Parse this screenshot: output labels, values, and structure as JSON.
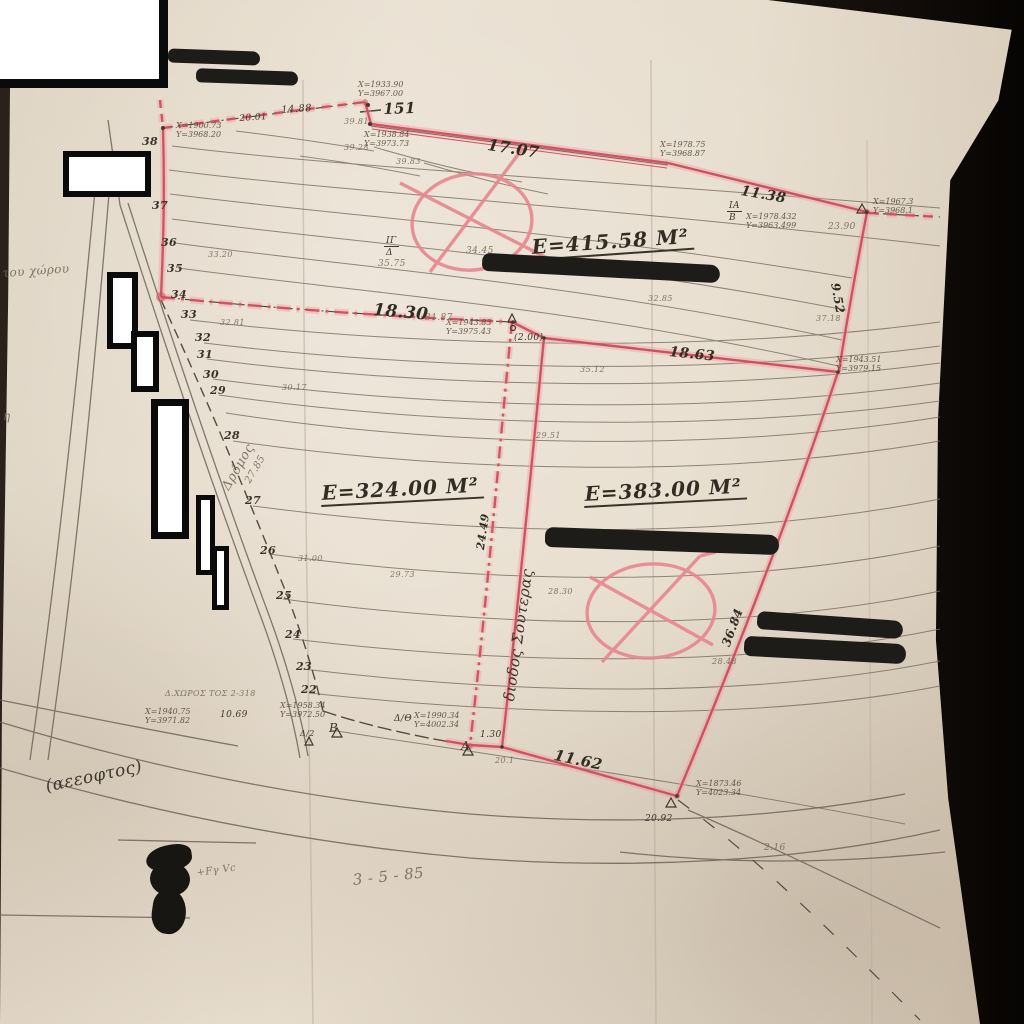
{
  "colors": {
    "boundary_red": "#cf4f5c",
    "paper": "#e6dccd",
    "ink": "#3f372c",
    "pencil_gray": "#77695A",
    "marker_black": "#1e1c19"
  },
  "annotations": [
    {
      "name": "parcel-area-1",
      "t": "E=415.58 M²",
      "x": 530,
      "y": 236,
      "s": 20,
      "r": -4,
      "cls": "area"
    },
    {
      "name": "parcel-area-2",
      "t": "E=324.00 M²",
      "x": 320,
      "y": 482,
      "s": 20,
      "r": -3,
      "cls": "area"
    },
    {
      "name": "parcel-area-3",
      "t": "E=383.00 M²",
      "x": 583,
      "y": 483,
      "s": 20,
      "r": -3,
      "cls": "area"
    },
    {
      "name": "length-151",
      "t": "151",
      "x": 383,
      "y": 101,
      "s": 15,
      "r": -2,
      "cls": "len"
    },
    {
      "name": "length-17-07",
      "t": "17.07",
      "x": 489,
      "y": 136,
      "s": 16,
      "r": 9,
      "cls": "len"
    },
    {
      "name": "length-11-38",
      "t": "11.38",
      "x": 742,
      "y": 184,
      "s": 14,
      "r": 10,
      "cls": "len"
    },
    {
      "name": "length-18-30",
      "t": "18.30",
      "x": 374,
      "y": 301,
      "s": 17,
      "r": 5,
      "cls": "len"
    },
    {
      "name": "length-18-63",
      "t": "18.63",
      "x": 670,
      "y": 345,
      "s": 14,
      "r": 6,
      "cls": "len"
    },
    {
      "name": "length-11-62",
      "t": "11.62",
      "x": 556,
      "y": 747,
      "s": 15,
      "r": 12,
      "cls": "len"
    },
    {
      "name": "length-9-52",
      "t": "9.52",
      "x": 841,
      "y": 282,
      "s": 12,
      "r": 80,
      "cls": "len"
    },
    {
      "name": "length-24-49",
      "t": "24.49",
      "x": 475,
      "y": 549,
      "s": 11,
      "r": -82,
      "cls": "len"
    },
    {
      "name": "length-36-84",
      "t": "36.84",
      "x": 720,
      "y": 644,
      "s": 12,
      "r": -70,
      "cls": "len"
    },
    {
      "name": "length-14-88",
      "t": "14.88",
      "x": 281,
      "y": 105,
      "s": 10,
      "r": -4,
      "cls": "ink"
    },
    {
      "name": "length-20-01",
      "t": "20.01",
      "x": 239,
      "y": 114,
      "s": 9,
      "r": -4,
      "cls": "ink"
    },
    {
      "name": "length-31-87",
      "t": "31.87",
      "x": 425,
      "y": 313,
      "s": 9,
      "cls": "pencil"
    },
    {
      "name": "length-10-69",
      "t": "10.69",
      "x": 220,
      "y": 710,
      "s": 9,
      "cls": "ink"
    },
    {
      "name": "length-1-30",
      "t": "1.30",
      "x": 480,
      "y": 730,
      "s": 9,
      "cls": "ink"
    },
    {
      "name": "length-2-00",
      "t": "(2.00)",
      "x": 514,
      "y": 333,
      "s": 9,
      "cls": "ink"
    },
    {
      "name": "length-2-16",
      "t": "2.16",
      "x": 764,
      "y": 843,
      "s": 9,
      "cls": "pencil"
    },
    {
      "name": "length-20-92",
      "t": "20.92",
      "x": 645,
      "y": 814,
      "s": 9,
      "cls": "ink"
    },
    {
      "name": "length-20-1",
      "t": "20.1",
      "x": 495,
      "y": 757,
      "s": 8,
      "cls": "pencil"
    },
    {
      "name": "corridor-label",
      "t": "διοδος Σουτερας",
      "x": 501,
      "y": 700,
      "s": 15,
      "r": -82,
      "cls": "ink"
    },
    {
      "name": "road-label",
      "t": "Δρόμος",
      "x": 220,
      "y": 486,
      "s": 13,
      "r": -60,
      "cls": "pencil"
    },
    {
      "name": "elev-27-85",
      "t": "27.85",
      "x": 243,
      "y": 480,
      "s": 10,
      "r": -60,
      "cls": "pencil"
    },
    {
      "name": "contour-38",
      "t": "38",
      "x": 142,
      "y": 136,
      "s": 11,
      "cls": "num"
    },
    {
      "name": "contour-37",
      "t": "37",
      "x": 152,
      "y": 200,
      "s": 11,
      "cls": "num"
    },
    {
      "name": "contour-36",
      "t": "36",
      "x": 161,
      "y": 237,
      "s": 11,
      "cls": "num"
    },
    {
      "name": "contour-35",
      "t": "35",
      "x": 167,
      "y": 263,
      "s": 11,
      "cls": "num"
    },
    {
      "name": "contour-34",
      "t": "34",
      "x": 171,
      "y": 289,
      "s": 11,
      "cls": "num"
    },
    {
      "name": "contour-33",
      "t": "33",
      "x": 181,
      "y": 309,
      "s": 11,
      "cls": "num"
    },
    {
      "name": "contour-32",
      "t": "32",
      "x": 195,
      "y": 332,
      "s": 11,
      "cls": "num"
    },
    {
      "name": "contour-31",
      "t": "31",
      "x": 197,
      "y": 349,
      "s": 11,
      "cls": "num"
    },
    {
      "name": "contour-30",
      "t": "30",
      "x": 203,
      "y": 369,
      "s": 11,
      "cls": "num"
    },
    {
      "name": "contour-29",
      "t": "29",
      "x": 210,
      "y": 385,
      "s": 11,
      "cls": "num"
    },
    {
      "name": "contour-28",
      "t": "28",
      "x": 224,
      "y": 430,
      "s": 11,
      "cls": "num"
    },
    {
      "name": "contour-27",
      "t": "27",
      "x": 245,
      "y": 495,
      "s": 11,
      "cls": "num"
    },
    {
      "name": "contour-26",
      "t": "26",
      "x": 260,
      "y": 545,
      "s": 11,
      "cls": "num"
    },
    {
      "name": "contour-25",
      "t": "25",
      "x": 276,
      "y": 590,
      "s": 11,
      "cls": "num"
    },
    {
      "name": "contour-24",
      "t": "24",
      "x": 285,
      "y": 629,
      "s": 11,
      "cls": "num"
    },
    {
      "name": "contour-23",
      "t": "23",
      "x": 296,
      "y": 661,
      "s": 11,
      "cls": "num"
    },
    {
      "name": "contour-22",
      "t": "22",
      "x": 301,
      "y": 684,
      "s": 11,
      "cls": "num"
    },
    {
      "name": "survey-coordinates",
      "t": "Χ=1900.73\nΥ=3968.20",
      "x": 176,
      "y": 122,
      "s": 8,
      "cls": "coords"
    },
    {
      "name": "survey-coordinates",
      "t": "Χ=1933.90\nΥ=3967.00",
      "x": 358,
      "y": 81,
      "s": 8,
      "cls": "coords"
    },
    {
      "name": "survey-coordinates",
      "t": "Χ=1938.84\nΥ=3973.73",
      "x": 364,
      "y": 131,
      "s": 8,
      "cls": "coords"
    },
    {
      "name": "survey-coordinates",
      "t": "Χ=1978.75\nΥ=3968.87",
      "x": 660,
      "y": 141,
      "s": 8,
      "cls": "coords"
    },
    {
      "name": "survey-coordinates",
      "t": "Χ=1967.3\nΥ=3968.1",
      "x": 873,
      "y": 198,
      "s": 8,
      "cls": "coords"
    },
    {
      "name": "survey-coordinates",
      "t": "Χ=1978.432\nΥ=3963.499",
      "x": 746,
      "y": 213,
      "s": 8,
      "cls": "coords"
    },
    {
      "name": "survey-coordinates",
      "t": "Χ=1943.83\nΥ=3975.43",
      "x": 446,
      "y": 319,
      "s": 8,
      "cls": "coords"
    },
    {
      "name": "survey-coordinates",
      "t": "Χ=1943.51\nΥ=3979.15",
      "x": 836,
      "y": 356,
      "s": 8,
      "cls": "coords"
    },
    {
      "name": "survey-coordinates",
      "t": "Χ=1940.75\nΥ=3971.82",
      "x": 145,
      "y": 708,
      "s": 8,
      "cls": "coords"
    },
    {
      "name": "survey-coordinates",
      "t": "Χ=1958.34\nΥ=3972.50",
      "x": 280,
      "y": 702,
      "s": 8,
      "cls": "coords"
    },
    {
      "name": "survey-coordinates",
      "t": "Χ=1990.34\nΥ=4002.34",
      "x": 414,
      "y": 712,
      "s": 8,
      "cls": "coords"
    },
    {
      "name": "survey-coordinates",
      "t": "Χ=1873.46\nΥ=4023.34",
      "x": 696,
      "y": 780,
      "s": 8,
      "cls": "coords"
    },
    {
      "name": "station-ia",
      "t": "ΙΑ",
      "x": 727,
      "y": 201,
      "s": 9,
      "cls": "frac"
    },
    {
      "name": "station-b-small",
      "t": "Β",
      "x": 729,
      "y": 213,
      "s": 9,
      "cls": "ink"
    },
    {
      "name": "station-ig",
      "t": "ΙΓ",
      "x": 384,
      "y": 236,
      "s": 9,
      "cls": "frac"
    },
    {
      "name": "station-d-small",
      "t": "Δ",
      "x": 386,
      "y": 248,
      "s": 9,
      "cls": "ink"
    },
    {
      "name": "elev-35-75",
      "t": "35.75",
      "x": 378,
      "y": 259,
      "s": 9,
      "cls": "pencil"
    },
    {
      "name": "elev-34-45",
      "t": "34.45",
      "x": 466,
      "y": 246,
      "s": 9,
      "cls": "pencil"
    },
    {
      "name": "station-gamma",
      "t": "Γ",
      "x": 607,
      "y": 261,
      "s": 10,
      "cls": "ink"
    },
    {
      "name": "station-B",
      "t": "Β",
      "x": 329,
      "y": 722,
      "s": 12,
      "cls": "ink"
    },
    {
      "name": "station-A",
      "t": "Α",
      "x": 461,
      "y": 740,
      "s": 12,
      "cls": "ink"
    },
    {
      "name": "station-d-theta",
      "t": "Δ/Θ",
      "x": 394,
      "y": 714,
      "s": 9,
      "cls": "ink"
    },
    {
      "name": "station-d-2",
      "t": "Δ/2",
      "x": 300,
      "y": 730,
      "s": 8,
      "cls": "ink"
    },
    {
      "name": "elev-39-81",
      "t": "39.81",
      "x": 344,
      "y": 118,
      "s": 8,
      "cls": "pencil"
    },
    {
      "name": "elev-39-28",
      "t": "39.28",
      "x": 344,
      "y": 144,
      "s": 8,
      "cls": "pencil"
    },
    {
      "name": "elev-39-83",
      "t": "39.83",
      "x": 396,
      "y": 158,
      "s": 8,
      "cls": "pencil"
    },
    {
      "name": "elev-23-90",
      "t": "23.90",
      "x": 828,
      "y": 222,
      "s": 9,
      "cls": "pencil"
    },
    {
      "name": "elev-33-20",
      "t": "33.20",
      "x": 208,
      "y": 251,
      "s": 8,
      "cls": "pencil"
    },
    {
      "name": "elev-32-81",
      "t": "32.81",
      "x": 220,
      "y": 319,
      "s": 8,
      "cls": "pencil"
    },
    {
      "name": "elev-32-85",
      "t": "32.85",
      "x": 648,
      "y": 295,
      "s": 8,
      "cls": "pencil"
    },
    {
      "name": "elev-37-18",
      "t": "37.18",
      "x": 816,
      "y": 315,
      "s": 8,
      "cls": "pencil"
    },
    {
      "name": "elev-35-12",
      "t": "35.12",
      "x": 580,
      "y": 366,
      "s": 8,
      "cls": "pencil"
    },
    {
      "name": "elev-30-17",
      "t": "30.17",
      "x": 282,
      "y": 384,
      "s": 8,
      "cls": "pencil"
    },
    {
      "name": "elev-29-51",
      "t": "29.51",
      "x": 536,
      "y": 432,
      "s": 8,
      "cls": "pencil"
    },
    {
      "name": "elev-31-00",
      "t": "31.00",
      "x": 298,
      "y": 555,
      "s": 8,
      "cls": "pencil"
    },
    {
      "name": "elev-29-73",
      "t": "29.73",
      "x": 390,
      "y": 571,
      "s": 8,
      "cls": "pencil"
    },
    {
      "name": "elev-28-30",
      "t": "28.30",
      "x": 548,
      "y": 588,
      "s": 8,
      "cls": "pencil"
    },
    {
      "name": "elev-30-48",
      "t": "30.48",
      "x": 752,
      "y": 541,
      "s": 8,
      "cls": "pencil"
    },
    {
      "name": "elev-28-48",
      "t": "28.48",
      "x": 712,
      "y": 658,
      "s": 8,
      "cls": "pencil"
    },
    {
      "name": "road-name-paren",
      "t": "(αεεοφτος)",
      "x": 44,
      "y": 778,
      "s": 17,
      "r": -12,
      "cls": "ink"
    },
    {
      "name": "note-tou-xorou",
      "t": "του χώρου",
      "x": 2,
      "y": 267,
      "s": 12,
      "r": -4,
      "cls": "pencil"
    },
    {
      "name": "date",
      "t": "3 - 5 - 85",
      "x": 352,
      "y": 872,
      "s": 15,
      "r": -6,
      "cls": "pencil"
    },
    {
      "name": "initials",
      "t": "+Fγ Vc",
      "x": 196,
      "y": 868,
      "s": 10,
      "r": -8,
      "cls": "pencil"
    },
    {
      "name": "letter-eta",
      "t": "η",
      "x": 3,
      "y": 410,
      "s": 12,
      "cls": "pencil"
    },
    {
      "name": "scribble-row",
      "t": "Δ.ΧΩΡΟΣ ΤΟΣ 2-318",
      "x": 165,
      "y": 690,
      "s": 8,
      "cls": "pencil"
    }
  ]
}
